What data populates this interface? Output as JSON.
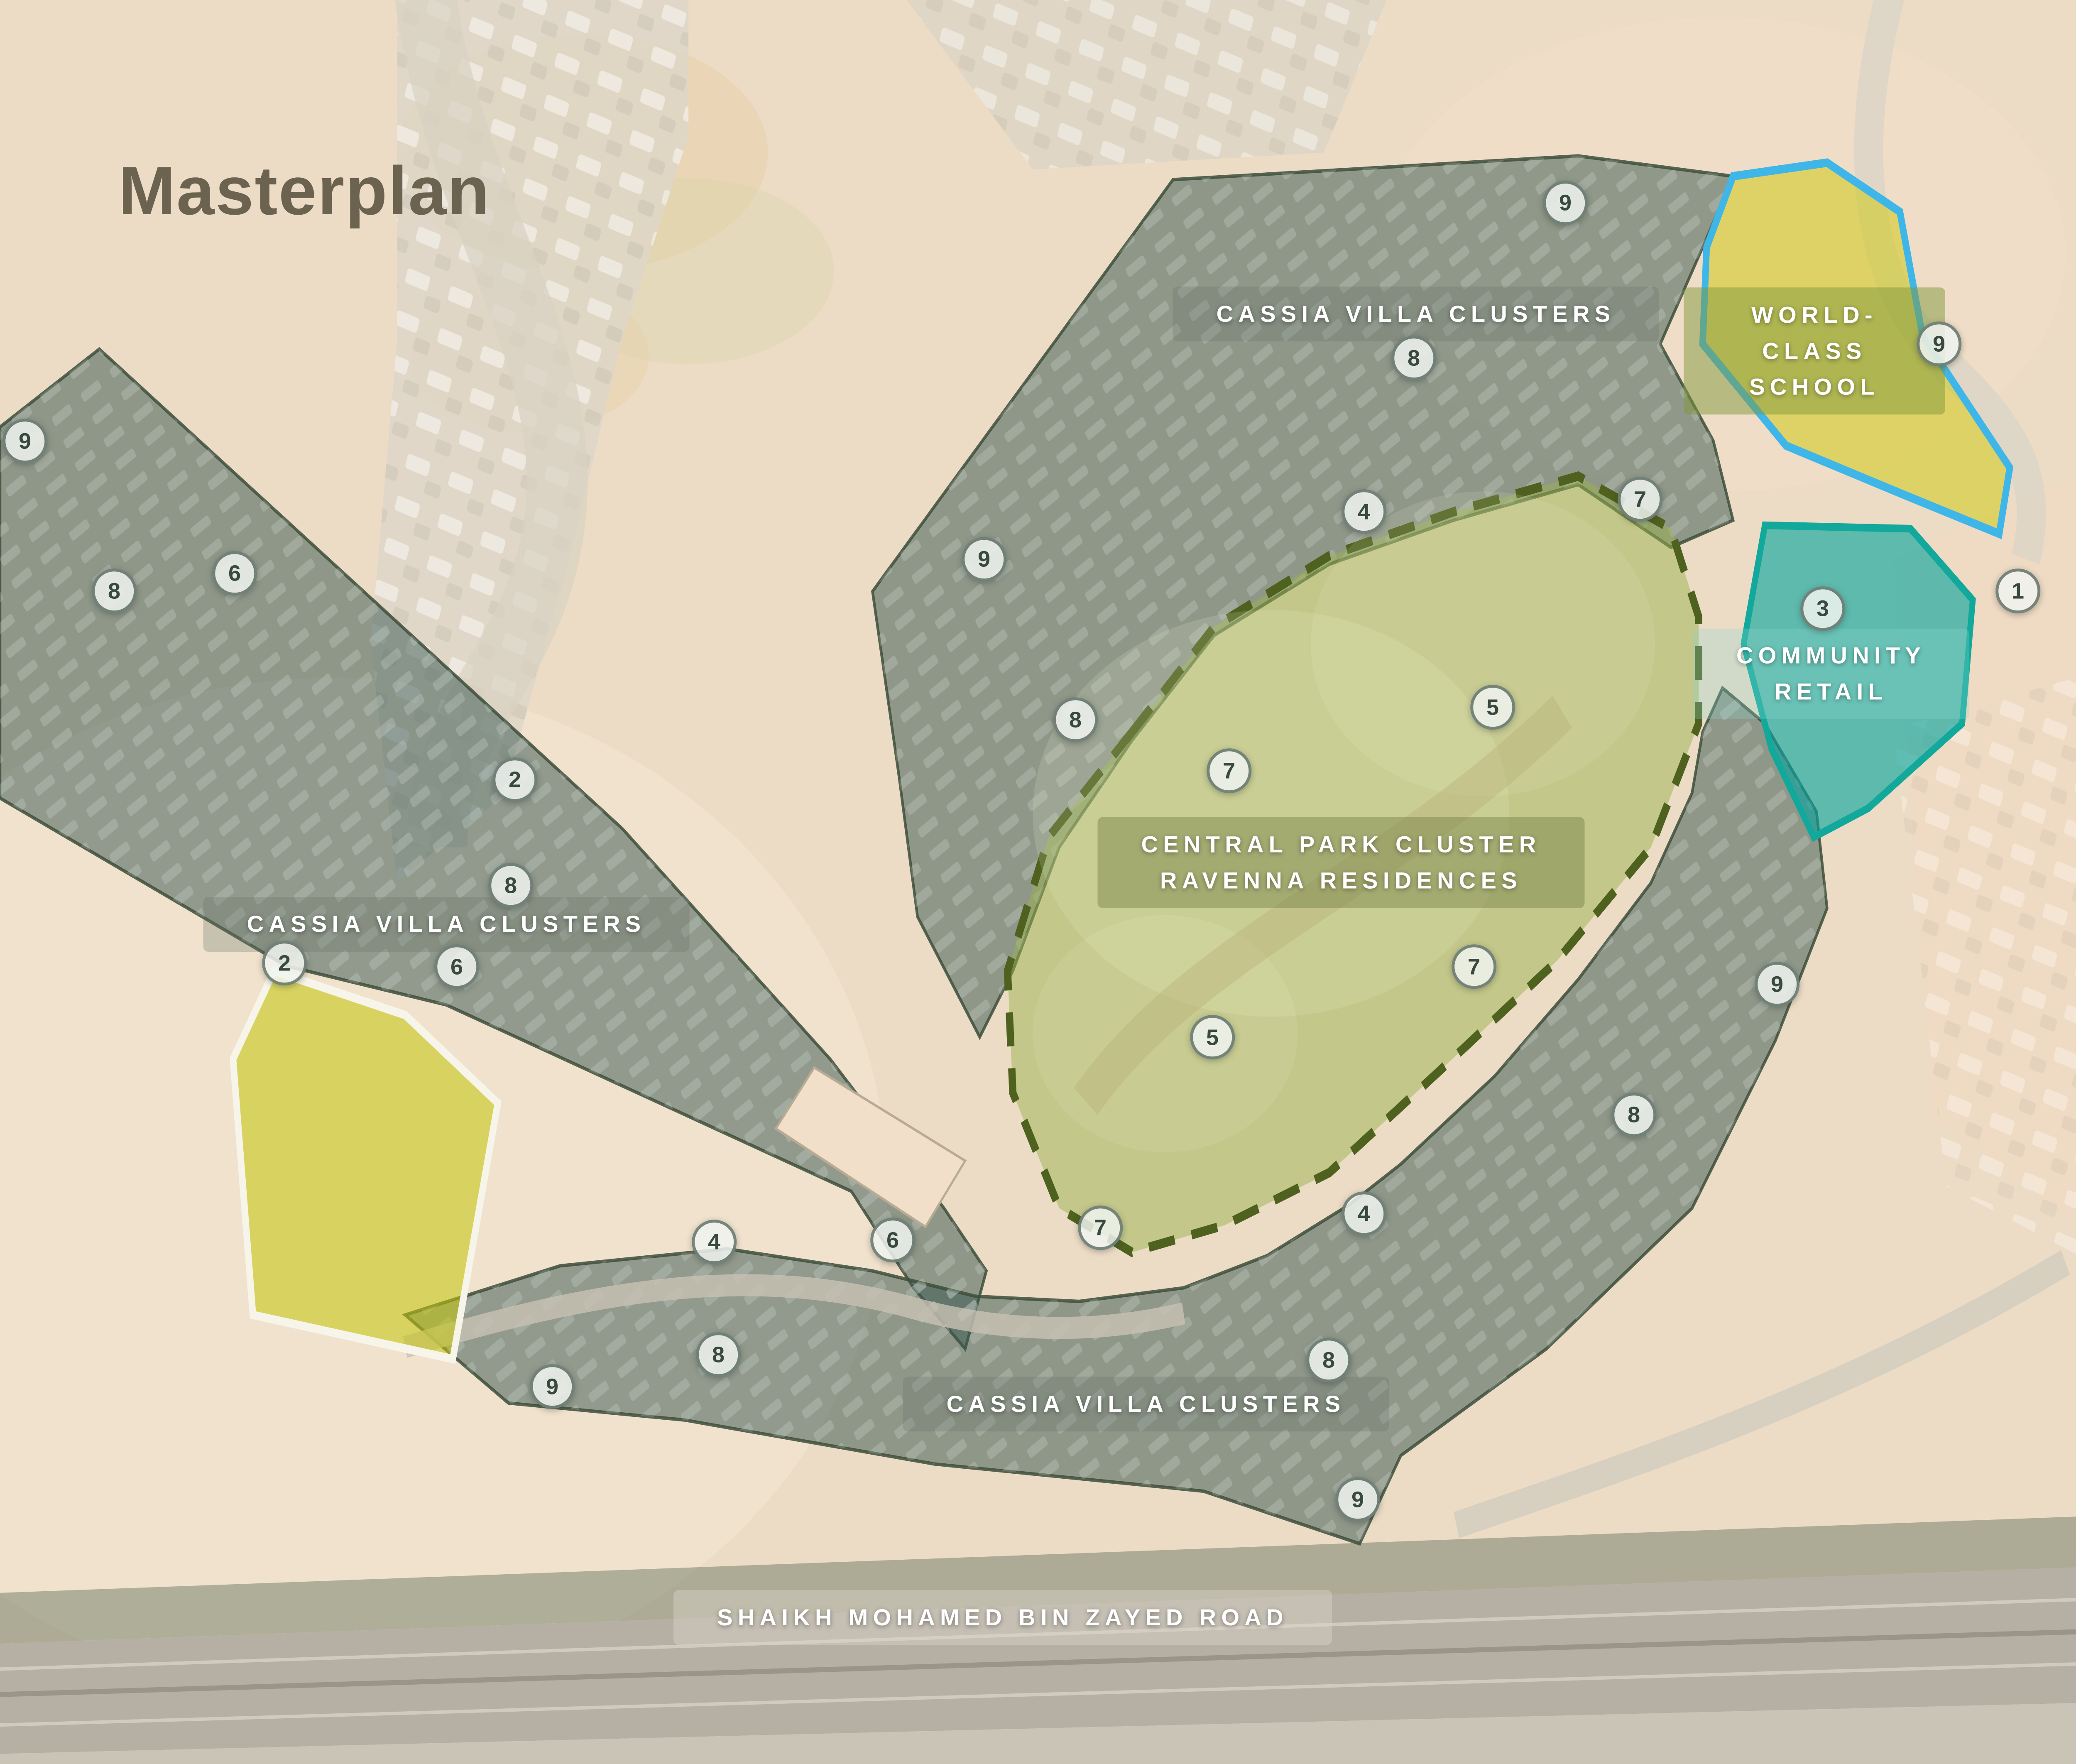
{
  "map": {
    "title": "Masterplan",
    "labels": {
      "cassia_top": "CASSIA VILLA CLUSTERS",
      "cassia_left": "CASSIA VILLA CLUSTERS",
      "cassia_bottom": "CASSIA VILLA CLUSTERS",
      "central_park": "CENTRAL PARK CLUSTER\nRAVENNA RESIDENCES",
      "school": "WORLD-CLASS\nSCHOOL",
      "retail": "COMMUNITY\nRETAIL",
      "road": "SHAIKH MOHAMED BIN ZAYED ROAD"
    },
    "markers": [
      {
        "value": "9",
        "x": 75.4,
        "y": 11.5
      },
      {
        "value": "8",
        "x": 68.1,
        "y": 20.3
      },
      {
        "value": "9",
        "x": 93.4,
        "y": 19.5
      },
      {
        "value": "1",
        "x": 97.2,
        "y": 33.5
      },
      {
        "value": "3",
        "x": 87.8,
        "y": 34.5
      },
      {
        "value": "4",
        "x": 65.7,
        "y": 29.0
      },
      {
        "value": "7",
        "x": 79.0,
        "y": 28.3
      },
      {
        "value": "9",
        "x": 47.4,
        "y": 31.7
      },
      {
        "value": "8",
        "x": 51.8,
        "y": 40.8
      },
      {
        "value": "5",
        "x": 71.9,
        "y": 40.1
      },
      {
        "value": "7",
        "x": 59.2,
        "y": 43.7
      },
      {
        "value": "6",
        "x": 11.3,
        "y": 32.5
      },
      {
        "value": "8",
        "x": 5.5,
        "y": 33.5
      },
      {
        "value": "9",
        "x": 1.2,
        "y": 25.0
      },
      {
        "value": "2",
        "x": 24.8,
        "y": 44.2
      },
      {
        "value": "8",
        "x": 24.6,
        "y": 50.2
      },
      {
        "value": "2",
        "x": 13.7,
        "y": 54.6
      },
      {
        "value": "6",
        "x": 22.0,
        "y": 54.8
      },
      {
        "value": "7",
        "x": 71.0,
        "y": 54.8
      },
      {
        "value": "9",
        "x": 85.6,
        "y": 55.8
      },
      {
        "value": "8",
        "x": 78.7,
        "y": 63.2
      },
      {
        "value": "5",
        "x": 58.4,
        "y": 58.8
      },
      {
        "value": "6",
        "x": 43.0,
        "y": 70.3
      },
      {
        "value": "4",
        "x": 34.4,
        "y": 70.4
      },
      {
        "value": "7",
        "x": 53.0,
        "y": 69.6
      },
      {
        "value": "4",
        "x": 65.7,
        "y": 68.8
      },
      {
        "value": "8",
        "x": 34.6,
        "y": 76.8
      },
      {
        "value": "9",
        "x": 26.6,
        "y": 78.6
      },
      {
        "value": "8",
        "x": 64.0,
        "y": 77.1
      },
      {
        "value": "9",
        "x": 65.4,
        "y": 85.0
      }
    ],
    "colors": {
      "sand": "#ecdcc6",
      "sand_light": "#f4e8d4",
      "sand_pink": "#f1d9c2",
      "villa_overlay": "rgba(58,88,80,0.52)",
      "villa_border": "#3d4d3a",
      "park_fill": "rgba(154,178,75,0.50)",
      "park_border": "#4e611e",
      "school_fill": "rgba(206,200,5,0.50)",
      "school_border": "#3fb6e8",
      "retail_fill": "rgba(5,165,158,0.62)",
      "retail_border": "#12a89b",
      "pentagon_fill": "rgba(196,198,10,0.55)",
      "pentagon_border": "#f7f4ea",
      "title": "#6b6350",
      "marker_bg": "rgba(240,243,240,0.85)",
      "marker_border": "rgba(55,75,65,0.65)",
      "marker_text": "#39493f"
    }
  }
}
